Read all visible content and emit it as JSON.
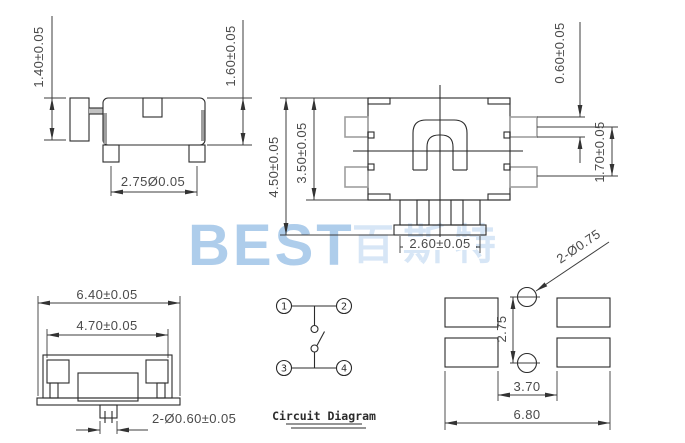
{
  "title": "tactile-switch-engineering-drawing",
  "colors": {
    "background": "#ffffff",
    "line_dark": "#2b2b2b",
    "line_gray": "#9e9e9e",
    "dimension_text": "#4a4a4a",
    "watermark_latin": "#aecdeb",
    "watermark_cjk": "#d7e6f6"
  },
  "watermark": {
    "latin": "BEST",
    "cjk": "百斯特"
  },
  "side_view": {
    "dim_button_height": "1.40±0.05",
    "dim_body_height": "1.60±0.05",
    "dim_feet_pitch": "2.75Ø0.05"
  },
  "top_view": {
    "dim_overall_height": "4.50±0.05",
    "dim_body_height": "3.50±0.05",
    "dim_button_width": "2.60±0.05",
    "dim_terminal_thickness": "0.60±0.05",
    "dim_terminal_pitch": "1.70±0.05"
  },
  "front_view": {
    "dim_overall_width": "6.40±0.05",
    "dim_body_width": "4.70±0.05",
    "dim_stem": "2-Ø0.60±0.05"
  },
  "circuit_diagram": {
    "label": "Circuit Diagram",
    "terminals": [
      "1",
      "2",
      "3",
      "4"
    ]
  },
  "pcb_layout": {
    "dim_holes": "2-Ø0.75",
    "dim_hole_pitch": "2.75",
    "dim_pad_gap": "3.70",
    "dim_overall_width": "6.80"
  }
}
